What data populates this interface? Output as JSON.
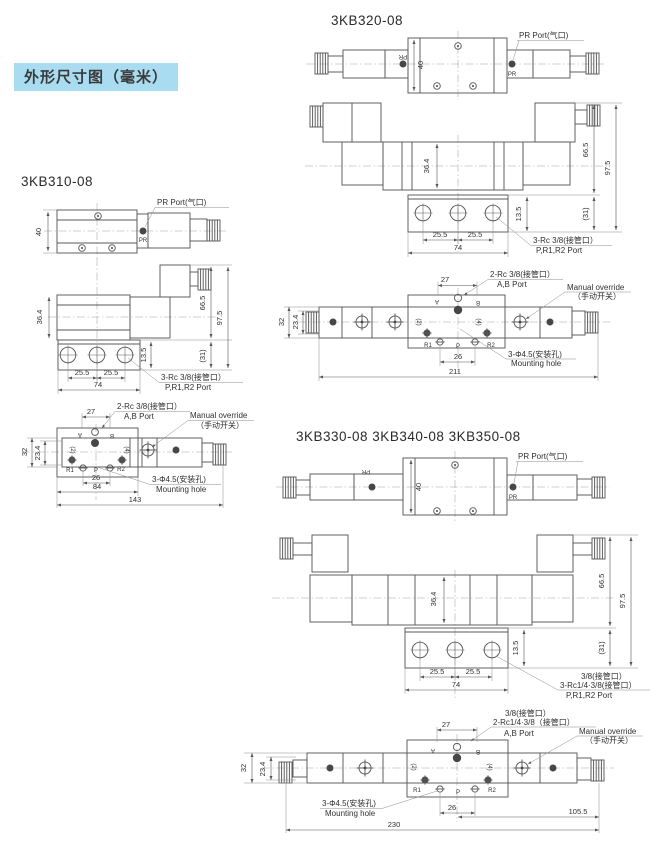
{
  "page": {
    "badge": "外形尺寸图（毫米）"
  },
  "sections": {
    "s310": {
      "title": "3KB310-08"
    },
    "s320": {
      "title": "3KB320-08"
    },
    "s330": {
      "title": "3KB330-08 3KB340-08 3KB350-08"
    }
  },
  "labels": {
    "pr_port": "PR Port(气口)",
    "pr": "PR",
    "manual_override_en": "Manual override",
    "manual_override_cn": "（手动开关）",
    "mounting_cn": "3-Φ4.5(安装孔)",
    "mounting_en": "Mounting hole",
    "rc38_3": "3-Rc 3/8(接管口）",
    "rc38_2": "2-Rc 3/8(接管口）",
    "p_r1_r2": "P,R1,R2 Port",
    "ab": "A,B Port",
    "i38": "3/8(接管口）",
    "rc14_38_3": "3-Rc1/4·3/8(接管口）",
    "rc14_38_2": "2-Rc1/4·3/8（接管口）"
  },
  "ports": {
    "a": "A",
    "b": "B",
    "p": "P",
    "r1": "R1",
    "r2": "R2",
    "n2": "(2)",
    "n4": "(4)"
  },
  "dims": {
    "d40": "40",
    "d364": "36.4",
    "d665": "66.5",
    "d975": "97.5",
    "d31": "(31)",
    "d135": "13.5",
    "d255": "25.5",
    "d74": "74",
    "d27": "27",
    "d26": "26",
    "d32": "32",
    "d234": "23.4",
    "d84": "84",
    "d143": "143",
    "d211": "211",
    "d1055": "105.5",
    "d230": "230"
  }
}
